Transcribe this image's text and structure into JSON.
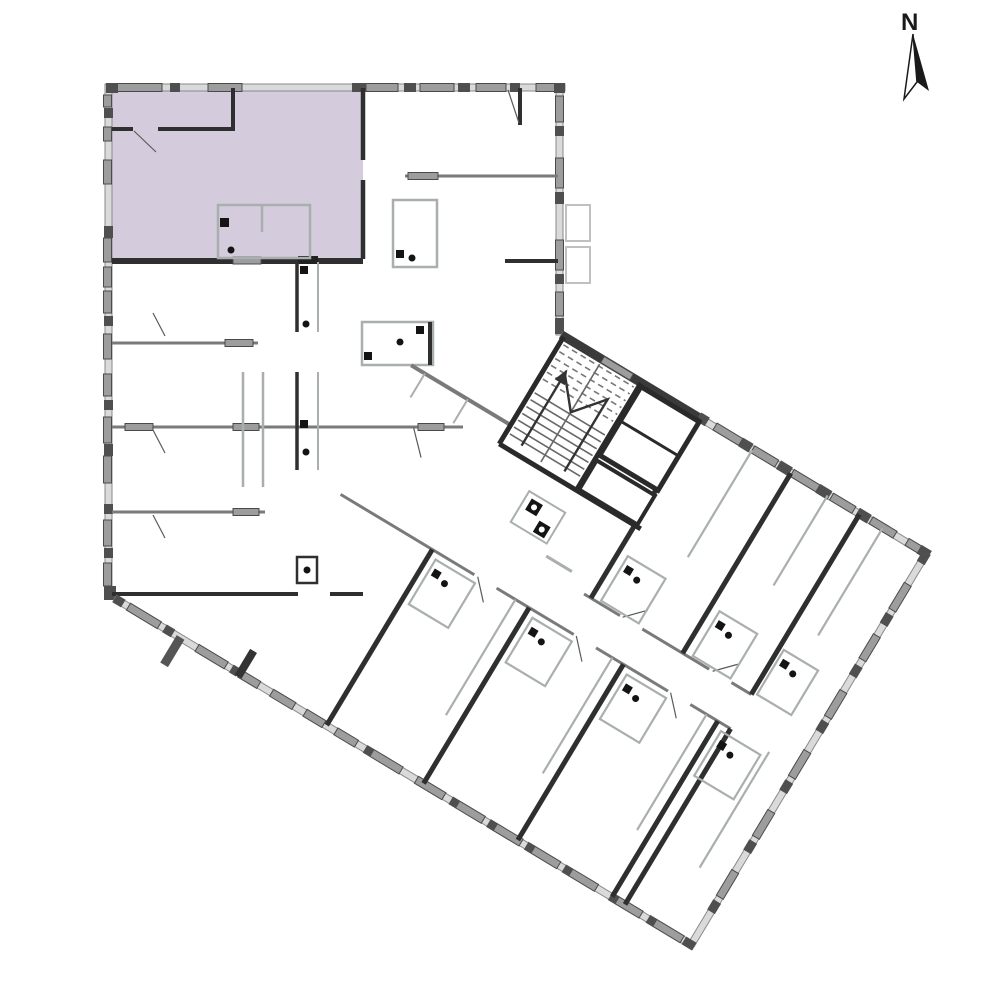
{
  "document": {
    "kind": "architectural floor plan",
    "description": "Building storey plan with one apartment unit highlighted in lavender; orthogonal wing at top-left and rotated wing toward bottom-right with central stair core"
  },
  "compass": {
    "label": "N"
  },
  "colors": {
    "background": "#ffffff",
    "highlight_unit": "#d4ccdc",
    "wall_dark": "#2f2f2f",
    "wall_medium": "#7a7a7a",
    "wall_light": "#a9aeae",
    "exterior_band": "#dadada",
    "window_fill": "#9d9d9d",
    "window_stroke": "#4a4a4a",
    "stair_lines": "#676767",
    "north_arrow": "#1a1a1a"
  },
  "plan": {
    "highlighted_unit_label": "",
    "rotation_of_lower_wing_deg": 31
  }
}
